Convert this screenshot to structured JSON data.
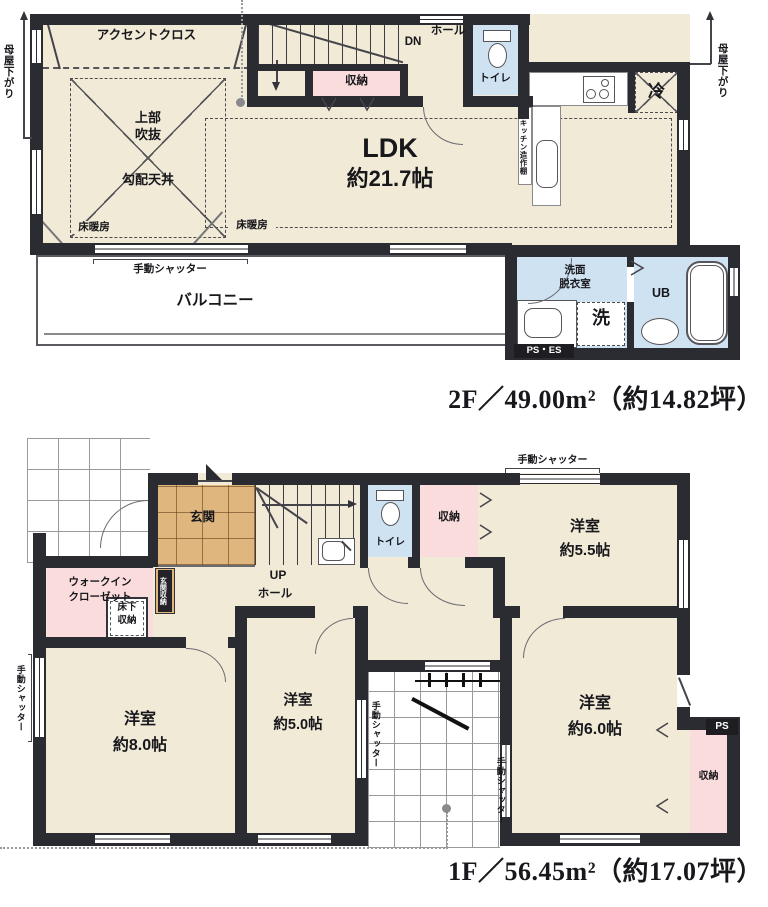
{
  "floor2": {
    "area_label": "2F／49.00m²（約14.82坪）",
    "accent_cloth": "アクセントクロス",
    "void_upper_1": "上部",
    "void_upper_2": "吹抜",
    "sloped_ceiling": "勾配天井",
    "floor_heating": "床暖房",
    "manual_shutter": "手動シャッター",
    "balcony": "バルコニー",
    "ldk_name": "LDK",
    "ldk_size": "約21.7帖",
    "dn": "DN",
    "hall": "ホール",
    "storage": "収納",
    "toilet": "トイレ",
    "kitchen_shelf": "キッチン造作棚",
    "fridge": "冷",
    "washroom_1": "洗面",
    "washroom_2": "脱衣室",
    "unit_bath": "UB",
    "laundry": "洗",
    "ps_es": "PS・ES",
    "eaves_note": "母屋下がり"
  },
  "floor1": {
    "area_label": "1F／56.45m²（約17.07坪）",
    "entrance": "玄関",
    "entrance_storage": "玄関収納",
    "wic_1": "ウォークイン",
    "wic_2": "クローゼット",
    "underfloor_1": "床下",
    "underfloor_2": "収納",
    "up": "UP",
    "hall": "ホール",
    "toilet": "トイレ",
    "storage": "収納",
    "manual_shutter": "手動シャッター",
    "room_5_5_name": "洋室",
    "room_5_5_size": "約5.5帖",
    "room_8_0_name": "洋室",
    "room_8_0_size": "約8.0帖",
    "room_5_0_name": "洋室",
    "room_5_0_size": "約5.0帖",
    "room_6_0_name": "洋室",
    "room_6_0_size": "約6.0帖",
    "ps": "PS",
    "storage_2": "収納"
  }
}
